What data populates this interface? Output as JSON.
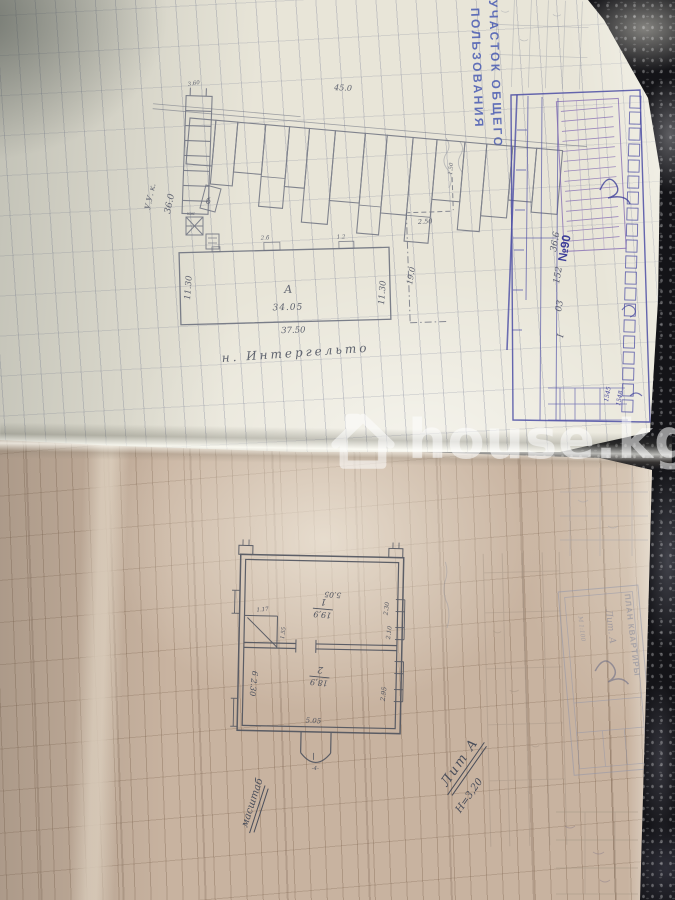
{
  "watermark": {
    "text": "house.kg"
  },
  "colors": {
    "stamp_blue": "#3b4fb0",
    "pen_blue": "#3c3e99",
    "pencil": "#5f6370",
    "paper_upper": "#e8e5d8",
    "paper_lower": "#c8b3a0"
  },
  "upper_page": {
    "stamp": {
      "line1": "УЧАСТОК ОБЩЕГО",
      "line2": "ПОЛЬЗОВАНИЯ"
    },
    "street_label": "н. Интергельто",
    "site_plan": {
      "street_width": "45.0",
      "strip_dim": "3.60",
      "area_note": "36.0",
      "corner_note": "У.У. к.",
      "shed_label": "б",
      "shed_mark": "кж",
      "left_dim": "11.30",
      "right_dim": "11.30",
      "building_label": "А",
      "inner_width": "34.05",
      "outer_width": "37.50",
      "bump1": "2.б",
      "bump2": "1.2",
      "dash_top": "1.50",
      "dash_width": "2.50",
      "dash_depth": "19.0"
    },
    "blue_table": {
      "order_no": "№90",
      "values": [
        "36.6",
        "152",
        "03",
        "I"
      ],
      "cell_a": "1545",
      "cell_b": "1548"
    }
  },
  "lower_page": {
    "flat_plan": {
      "top_dim": "5.05",
      "room1_no": "1",
      "room1_area": "19,9",
      "win_a": "2.30",
      "win_b": "2.10",
      "closet_a": "1.17",
      "closet_b": "1.55",
      "room2_no": "2",
      "room2_area": "18,9",
      "win_c": "2.95",
      "side_note": "6 2.30",
      "bottom_dim": "5.05",
      "porch_dim": "-4-"
    },
    "litera": "Лит А",
    "height_note": "Н=3,20",
    "scale_note": "масштаб",
    "stamp": {
      "title": "ПЛАН КВАРТИРЫ",
      "litera": "Лит. А",
      "scale": "М 1:100"
    }
  }
}
